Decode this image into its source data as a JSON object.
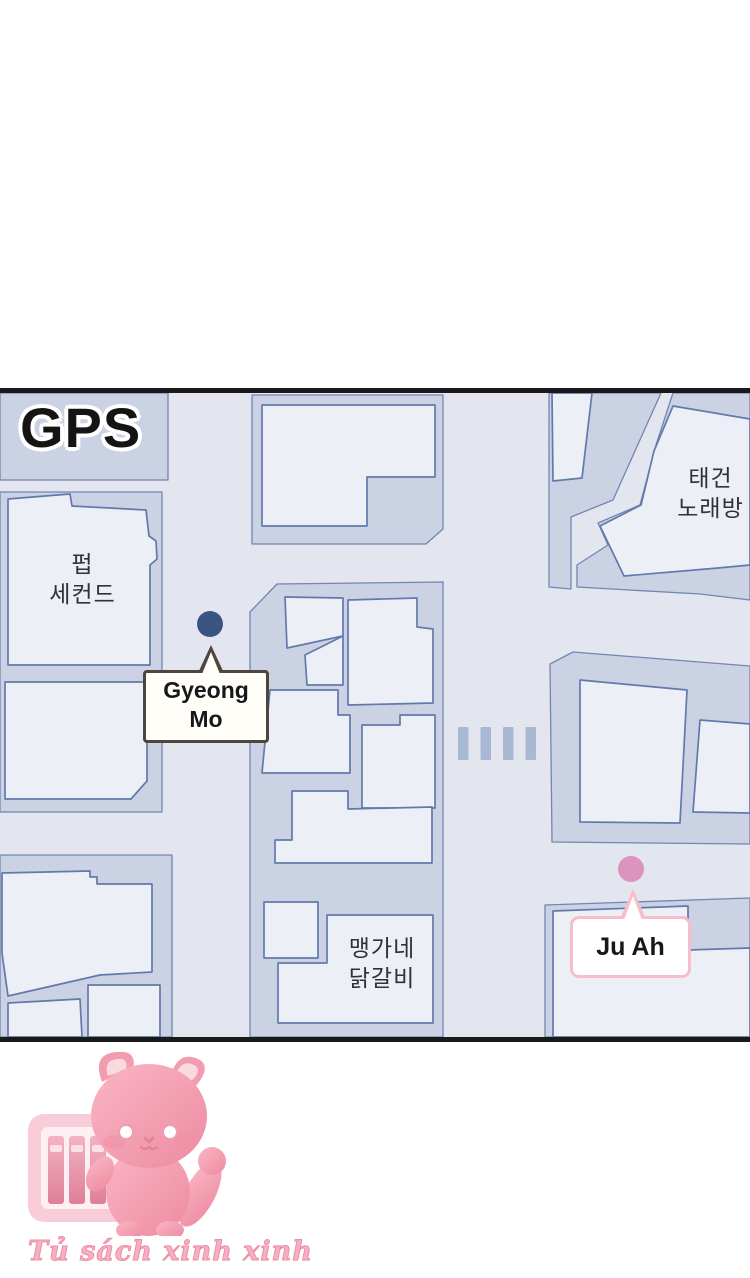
{
  "map_panel": {
    "gps_label": "GPS",
    "places": [
      {
        "id": "pub-second",
        "line1": "펍",
        "line2": "세컨드"
      },
      {
        "id": "taegeon-karaoke",
        "line1": "태건",
        "line2": "노래방"
      },
      {
        "id": "maengga-dakgalbi",
        "line1": "맹가네",
        "line2": "닭갈비"
      }
    ],
    "markers": [
      {
        "id": "gyeong-mo",
        "line1": "Gyeong",
        "line2": "Mo",
        "dot_color": "#3a5482",
        "bubble_border_color": "#4e453e"
      },
      {
        "id": "ju-ah",
        "line1": "Ju Ah",
        "dot_color": "#dc93bd",
        "bubble_border_color": "#f7bdca"
      }
    ],
    "colors": {
      "panel_border": "#191919",
      "road": "#e4e6ef",
      "lot": "#cbd2e3",
      "building": "#edeff6",
      "building_outline": "#6379ab",
      "crosswalk": "#a9b9d3"
    }
  },
  "watermark": {
    "text": "Tủ sách xinh xinh"
  }
}
